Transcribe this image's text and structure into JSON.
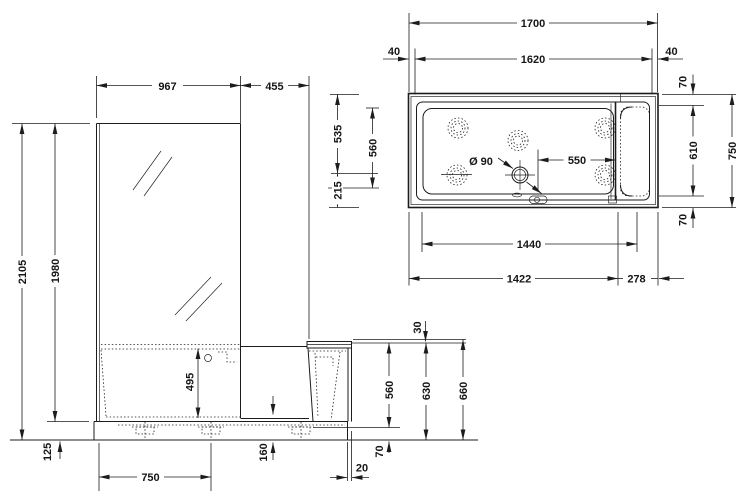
{
  "drawing": {
    "type": "technical-drawing",
    "subject": "walk-in bathtub with shower screen",
    "units": "mm",
    "line_color": "#1c1c1c",
    "background": "#ffffff",
    "elevation": {
      "view": "front elevation",
      "dims": {
        "glass_width": "967",
        "door_width": "455",
        "total_height": "2105",
        "glass_height": "1980",
        "inner_depth": "495",
        "plinth_height": "125",
        "foot_spacing": "750",
        "entry_height": "160",
        "panel_offset": "20",
        "seat_lip": "30",
        "rim_to_base": "560",
        "rim_to_floor": "630",
        "seat_to_floor": "660",
        "base_gap": "70"
      }
    },
    "plan": {
      "view": "top view",
      "dims": {
        "total_length": "1700",
        "inner_length": "1620",
        "rim_left": "40",
        "rim_right": "40",
        "rim_top": "70",
        "inner_width": "610",
        "total_width": "750",
        "rim_bottom": "70",
        "drain_offset_top": "535",
        "floor_width": "560",
        "drain_offset_bottom": "215",
        "drain_to_seat": "550",
        "drain_diameter": "Ø 90",
        "floor_length": "1440",
        "tub_length": "1422",
        "seat_depth": "278"
      }
    }
  }
}
